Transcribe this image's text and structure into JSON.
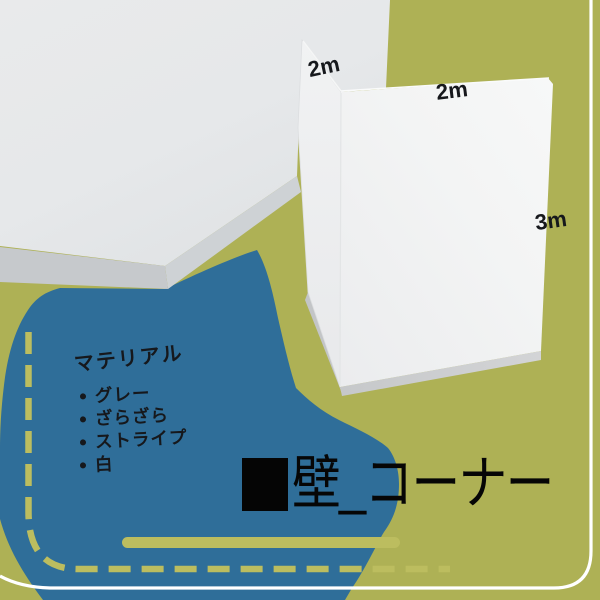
{
  "colors": {
    "background_olive": "#aeb155",
    "blob_blue": "#2f6e99",
    "accent_light_olive": "#bcbd5f",
    "frame_white": "#ffffff",
    "ink_black": "#16181c",
    "render_white": "#f4f5f5",
    "render_edge_gray": "#c9cbcd"
  },
  "dimensions": {
    "wing_width": "2m",
    "front_width": "2m",
    "height": "3m"
  },
  "materials": {
    "heading": "マテリアル",
    "items": [
      "グレー",
      "ざらざら",
      "ストライプ",
      "白"
    ]
  },
  "title": {
    "text": "壁_コーナー"
  }
}
